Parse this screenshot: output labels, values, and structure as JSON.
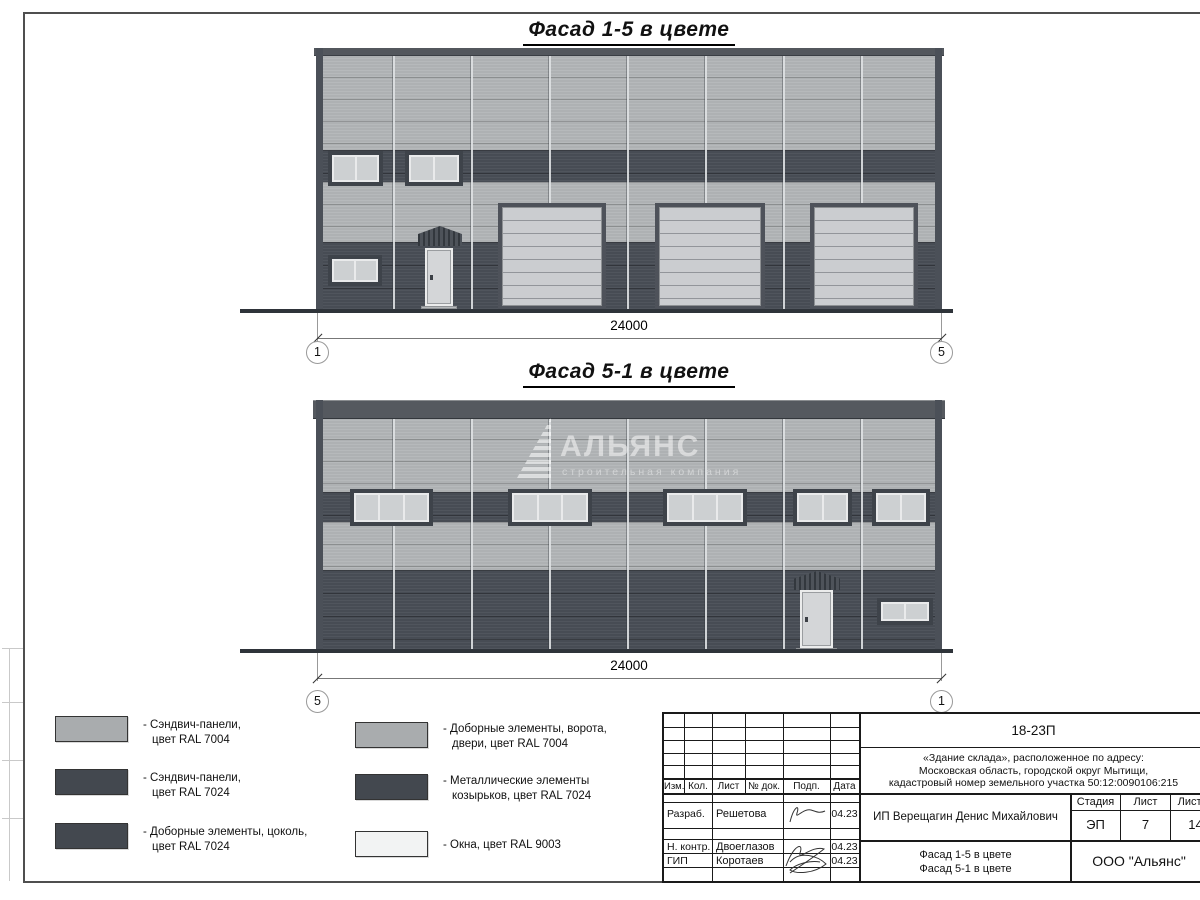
{
  "titles": {
    "facade_a": "Фасад 1-5 в цвете",
    "facade_b": "Фасад 5-1 в цвете"
  },
  "facade_a": {
    "dimension": "24000",
    "axis_left": "1",
    "axis_right": "5"
  },
  "facade_b": {
    "dimension": "24000",
    "axis_left": "5",
    "axis_right": "1"
  },
  "watermark": {
    "name": "АЛЬЯНС",
    "subtitle": "строительная компания"
  },
  "colors": {
    "ral7004": "#a9acae",
    "ral7024": "#474c54",
    "ral9003": "#f2f3f3"
  },
  "legend": {
    "items": [
      {
        "line1": "- Сэндвич-панели,",
        "line2": "цвет RAL 7004",
        "color": "#a9acae"
      },
      {
        "line1": "- Сэндвич-панели,",
        "line2": "цвет RAL 7024",
        "color": "#474c54"
      },
      {
        "line1": "- Доборные элементы, цоколь,",
        "line2": "цвет RAL 7024",
        "color": "#474c54"
      },
      {
        "line1": "- Доборные элементы, ворота,",
        "line2": "двери, цвет RAL 7004",
        "color": "#a9acae"
      },
      {
        "line1": "- Металлические элементы",
        "line2": "козырьков, цвет RAL 7024",
        "color": "#474c54"
      },
      {
        "line1": "- Окна, цвет RAL 9003",
        "line2": "",
        "color": "#f2f3f3"
      }
    ]
  },
  "stamp": {
    "doc_code": "18-23П",
    "address_lines": [
      "«Здание склада», расположенное по адресу:",
      "Московская область, городской округ Мытищи,",
      "кадастровый номер земельного участка 50:12:0090106:215"
    ],
    "header_cols": [
      "Изм.",
      "Кол.",
      "Лист",
      "№ док.",
      "Подп.",
      "Дата"
    ],
    "rows": [
      {
        "role": "Разраб.",
        "name": "Решетова",
        "date": "04.23"
      },
      {
        "role": "Н. контр.",
        "name": "Двоеглазов",
        "date": "04.23"
      },
      {
        "role": "ГИП",
        "name": "Коротаев",
        "date": "04.23"
      }
    ],
    "client": "ИП Верещагин Денис Михайлович",
    "sheet_title_lines": [
      "Фасад 1-5 в цвете",
      "Фасад 5-1 в цвете"
    ],
    "stage_label": "Стадия",
    "sheet_label": "Лист",
    "sheets_label": "Листов",
    "stage": "ЭП",
    "sheet": "7",
    "sheets": "14",
    "company": "ООО \"Альянс\""
  }
}
